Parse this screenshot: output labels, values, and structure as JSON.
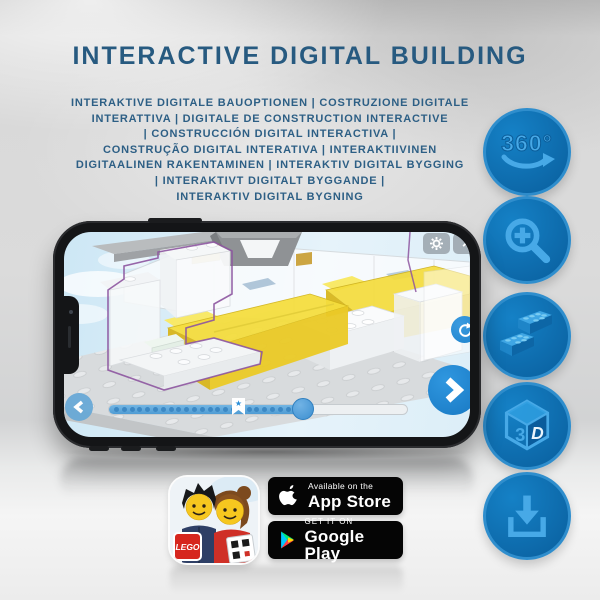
{
  "header": {
    "title": "INTERACTIVE DIGITAL BUILDING",
    "subtitle_lines": [
      "INTERAKTIVE DIGITALE BAUOPTIONEN | COSTRUZIONE DIGITALE",
      "INTERATTIVA | DIGITALE DE CONSTRUCTION INTERACTIVE",
      "| CONSTRUCCIÓN DIGITAL INTERACTIVA |",
      "CONSTRUÇÃO DIGITAL INTERATIVA | INTERAKTIIVINEN",
      "DIGITAALINEN RAKENTAMINEN | INTERAKTIV DIGITAL BYGGING",
      "| INTERAKTIVT DIGITALT BYGGANDE |",
      "INTERAKTIV DIGITAL BYGNING"
    ]
  },
  "feature_icons": {
    "rotation_label": "360°",
    "cube_left": "3",
    "cube_right": "D",
    "names": [
      "360-rotation",
      "zoom-in",
      "lego-bricks",
      "3d-view",
      "download"
    ]
  },
  "phone": {
    "ui": {
      "close_glyph": "×",
      "star_glyph": "★",
      "slider": {
        "progress_percent": 65,
        "dot_count": 23
      }
    }
  },
  "badges": {
    "lego_label": "LEGO",
    "app_store": {
      "tagline": "Available on the",
      "name": "App Store"
    },
    "google_play": {
      "tagline": "GET IT ON",
      "name": "Google Play"
    }
  },
  "colors": {
    "title_blue": "#275a80",
    "icon_circle_blue": "#0c66a6",
    "icon_glyph_blue": "#47a9e7",
    "ui_button_blue": "#2a8ed8",
    "bed_yellow": "#f2d83e",
    "selection_purple": "#8d55a0",
    "badge_black": "#050505"
  }
}
